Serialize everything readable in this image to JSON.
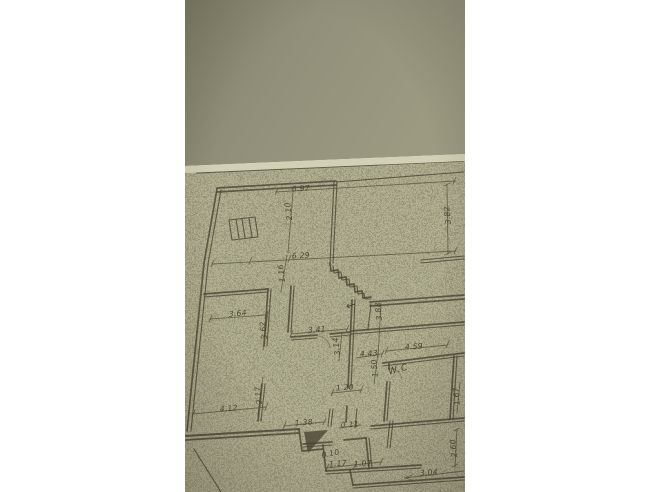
{
  "colors": {
    "margin": "#ffffff",
    "wall_dark": "#83816a",
    "wall_mid": "#92907a",
    "wall_light": "#9c9a81",
    "paper": "#b4b193",
    "paper_edge": "#d3d1b5",
    "ink": "#4b4734",
    "pencil": "#565136"
  },
  "plan": {
    "room_labels_note": "hand-drawn floor plan, handwritten dimensions in metres",
    "labels": [
      {
        "text": "6.97",
        "x": 301,
        "y": 191,
        "rot": -3
      },
      {
        "text": "6.29",
        "x": 301,
        "y": 258,
        "rot": -3
      },
      {
        "text": "3.64",
        "x": 238,
        "y": 316,
        "rot": -5
      },
      {
        "text": "3.41",
        "x": 317,
        "y": 332,
        "rot": -3
      },
      {
        "text": "4.43",
        "x": 369,
        "y": 356,
        "rot": -3
      },
      {
        "text": "4.59",
        "x": 414,
        "y": 349,
        "rot": -3
      },
      {
        "text": "1.20",
        "x": 345,
        "y": 390,
        "rot": -3
      },
      {
        "text": "4.12",
        "x": 229,
        "y": 411,
        "rot": -5
      },
      {
        "text": "1.38",
        "x": 304,
        "y": 425,
        "rot": -4
      },
      {
        "text": "0.11",
        "x": 350,
        "y": 427,
        "rot": -3
      },
      {
        "text": "0.10",
        "x": 331,
        "y": 456,
        "rot": -12
      },
      {
        "text": "1.17",
        "x": 338,
        "y": 466,
        "rot": -4
      },
      {
        "text": "1.07",
        "x": 363,
        "y": 466,
        "rot": -4
      },
      {
        "text": "3.04",
        "x": 429,
        "y": 475,
        "rot": -4
      },
      {
        "text": "W.C",
        "x": 399,
        "y": 372,
        "rot": -14,
        "big": true
      },
      {
        "text": "3.82",
        "x": 450,
        "y": 215,
        "rot": -96
      },
      {
        "text": "2.10",
        "x": 291,
        "y": 211,
        "rot": -97
      },
      {
        "text": "1.16",
        "x": 284,
        "y": 273,
        "rot": -97
      },
      {
        "text": "3.62",
        "x": 266,
        "y": 330,
        "rot": -97
      },
      {
        "text": "3.14",
        "x": 339,
        "y": 346,
        "rot": -97
      },
      {
        "text": "3.88",
        "x": 381,
        "y": 311,
        "rot": -96
      },
      {
        "text": "2.17",
        "x": 261,
        "y": 395,
        "rot": -97
      },
      {
        "text": "1.50",
        "x": 377,
        "y": 368,
        "rot": -95
      },
      {
        "text": "1.67",
        "x": 459,
        "y": 396,
        "rot": -95
      },
      {
        "text": "2.60",
        "x": 456,
        "y": 448,
        "rot": -95
      }
    ],
    "symbols": [
      {
        "name": "entrance-arrow-icon",
        "glyph": "←",
        "x": 352,
        "y": 309,
        "rot": -18
      }
    ]
  }
}
